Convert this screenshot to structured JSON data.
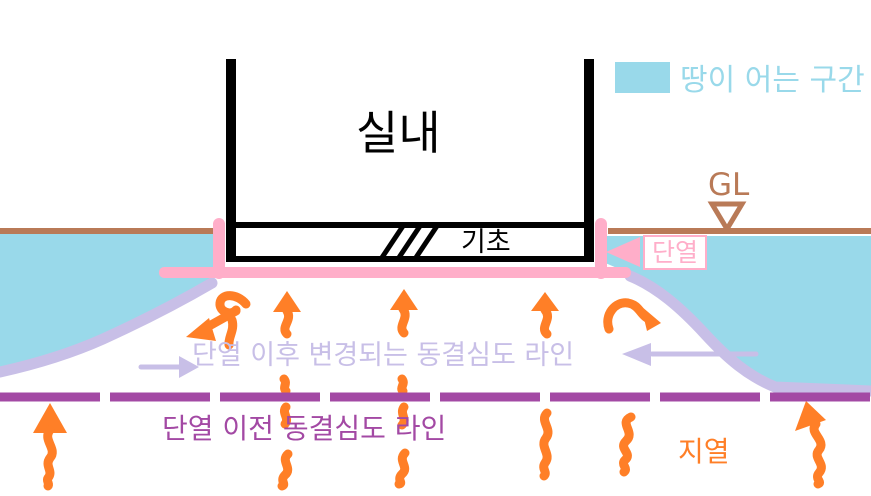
{
  "palette": {
    "black": "#000000",
    "white": "#ffffff",
    "cyan": "#99d9ea",
    "pink": "#ffaec9",
    "lavender": "#c8bfe7",
    "purple": "#a349a4",
    "orange": "#ff7f27",
    "brown": "#b97a57"
  },
  "labels": {
    "indoor": "실내",
    "foundation": "기초",
    "insulation": "단열",
    "ground_level": "GL",
    "legend_frozen_zone": "땅이 어는 구간",
    "frost_line_after": "단열 이후 변경되는 동결심도 라인",
    "frost_line_before": "단열 이전 동결심도 라인",
    "geothermal": "지열"
  }
}
